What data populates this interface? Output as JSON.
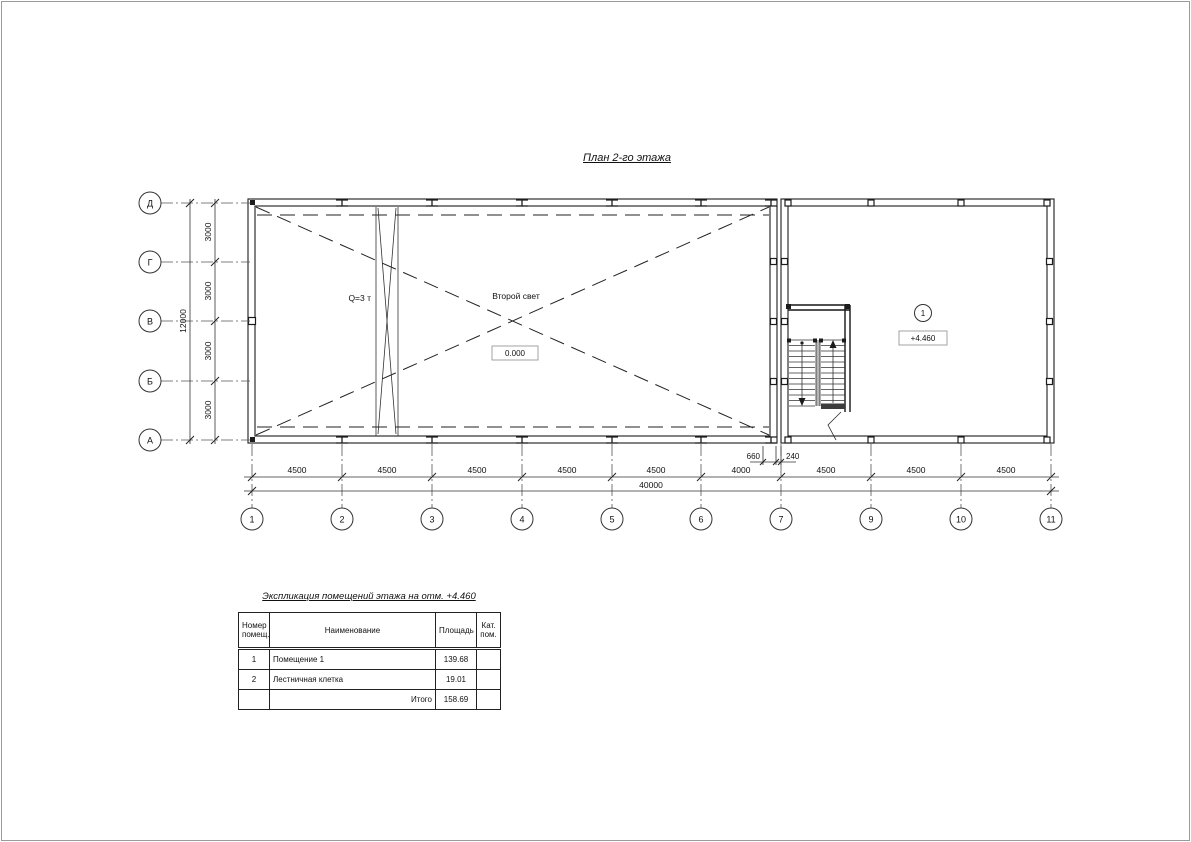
{
  "page": {
    "title": "План 2-го этажа"
  },
  "plan": {
    "labels": {
      "crane": "Q=3 т",
      "void": "Второй свет",
      "level_zero": "0.000",
      "level_mark": "+4.460",
      "room_mark": "1"
    },
    "axes": {
      "vertical": [
        "Д",
        "Г",
        "В",
        "Б",
        "А"
      ],
      "horizontal": [
        "1",
        "2",
        "3",
        "4",
        "5",
        "6",
        "7",
        "9",
        "10",
        "11"
      ]
    },
    "dims": {
      "left_segments": [
        "3000",
        "3000",
        "3000",
        "3000"
      ],
      "left_total": "12000",
      "bottom_segments": [
        "4500",
        "4500",
        "4500",
        "4500",
        "4500",
        "4000",
        "4500",
        "4500",
        "4500"
      ],
      "bottom_total": "40000",
      "offset_left": "660",
      "offset_right": "240"
    }
  },
  "table": {
    "title": "Экспликация помещений этажа на отм. +4.460",
    "headers": {
      "num_l1": "Номер",
      "num_l2": "помещ.",
      "name": "Наименование",
      "area": "Площадь",
      "cat_l1": "Кат.",
      "cat_l2": "пом."
    },
    "rows": [
      {
        "num": "1",
        "name": "Помещение 1",
        "area": "139.68",
        "cat": ""
      },
      {
        "num": "2",
        "name": "Лестничная клетка",
        "area": "19.01",
        "cat": ""
      }
    ],
    "total": {
      "label": "Итого",
      "area": "158.69",
      "cat": ""
    }
  }
}
